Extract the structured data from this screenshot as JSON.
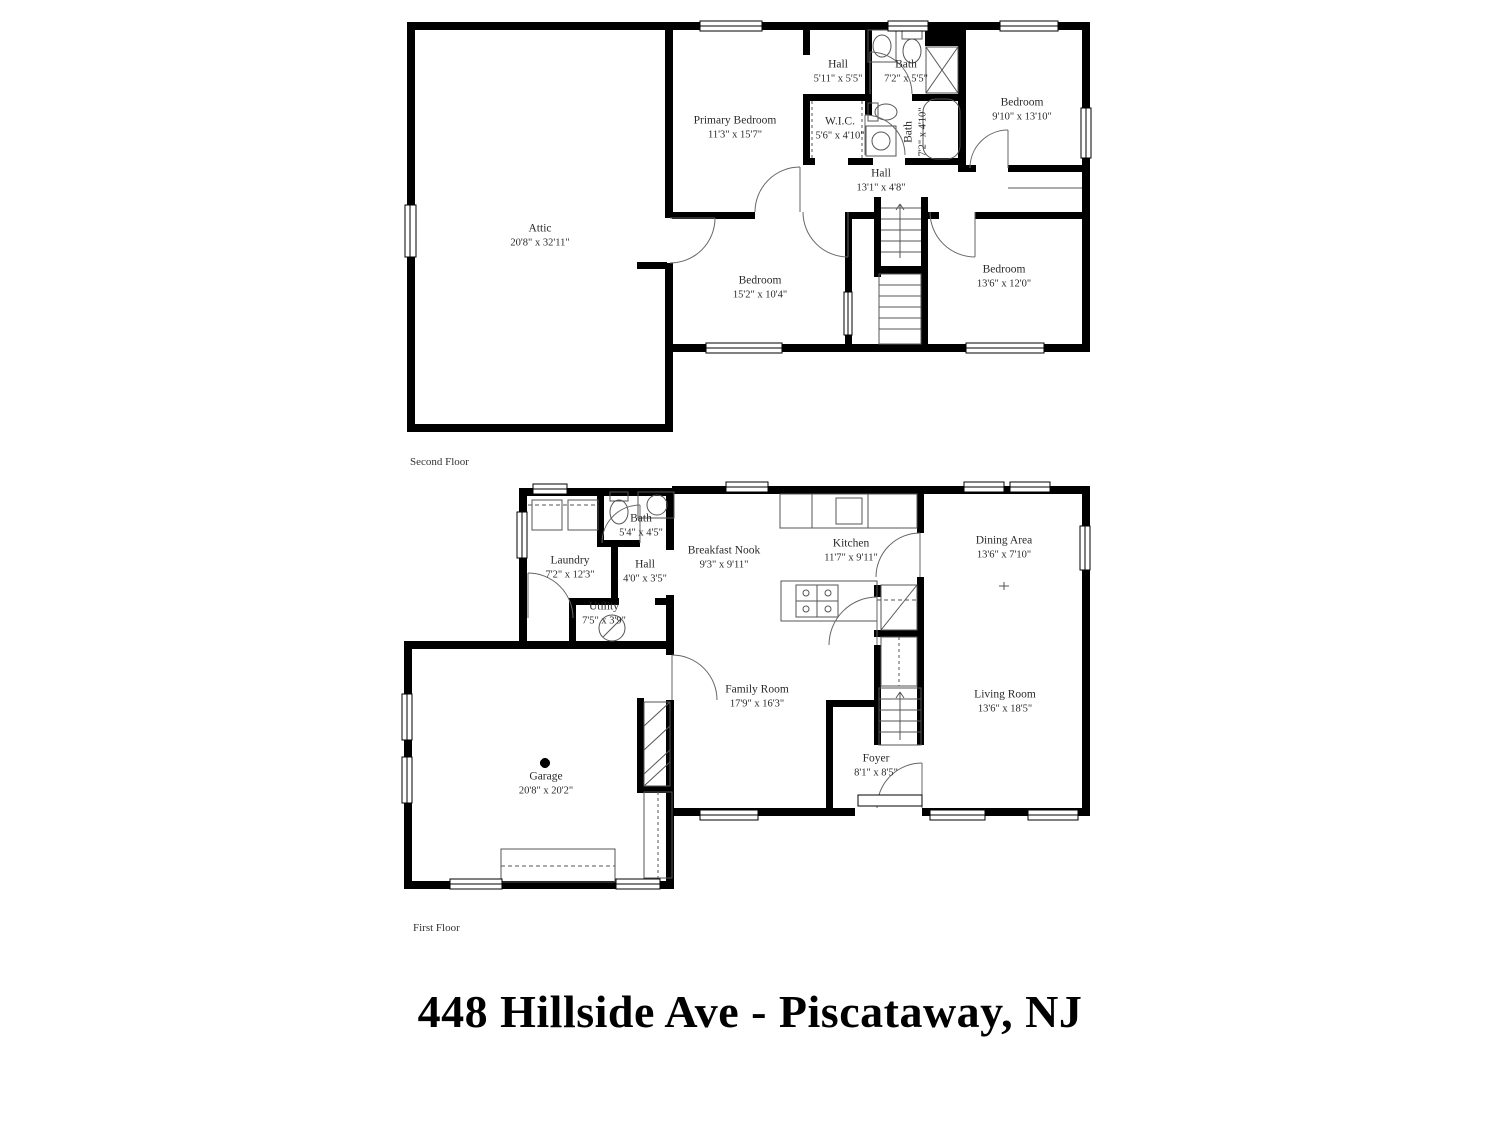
{
  "title": "448 Hillside Ave - Piscataway, NJ",
  "colors": {
    "walls": "#000000",
    "background": "#ffffff",
    "label_text": "#2a2a2a"
  },
  "floors": {
    "second": {
      "caption": "Second Floor",
      "rooms": {
        "hall_upper": {
          "name": "Hall",
          "dims": "5'11\" x 5'5\""
        },
        "bath_upper": {
          "name": "Bath",
          "dims": "7'2\" x 5'5\""
        },
        "bedroom_ne": {
          "name": "Bedroom",
          "dims": "9'10\" x 13'10\""
        },
        "primary_bedroom": {
          "name": "Primary Bedroom",
          "dims": "11'3\" x 15'7\""
        },
        "wic": {
          "name": "W.I.C.",
          "dims": "5'6\" x 4'10\""
        },
        "bath_ensuite": {
          "name": "Bath",
          "dims": "7'2\" x 4'10\""
        },
        "hall_main": {
          "name": "Hall",
          "dims": "13'1\" x 4'8\""
        },
        "attic": {
          "name": "Attic",
          "dims": "20'8\" x 32'11\""
        },
        "bedroom_sw": {
          "name": "Bedroom",
          "dims": "15'2\" x 10'4\""
        },
        "bedroom_se": {
          "name": "Bedroom",
          "dims": "13'6\" x 12'0\""
        }
      }
    },
    "first": {
      "caption": "First Floor",
      "rooms": {
        "bath": {
          "name": "Bath",
          "dims": "5'4\" x 4'5\""
        },
        "laundry": {
          "name": "Laundry",
          "dims": "7'2\" x 12'3\""
        },
        "hall": {
          "name": "Hall",
          "dims": "4'0\" x 3'5\""
        },
        "utility": {
          "name": "Utility",
          "dims": "7'5\" x 3'9\""
        },
        "breakfast_nook": {
          "name": "Breakfast Nook",
          "dims": "9'3\" x 9'11\""
        },
        "kitchen": {
          "name": "Kitchen",
          "dims": "11'7\" x 9'11\""
        },
        "dining_area": {
          "name": "Dining Area",
          "dims": "13'6\" x 7'10\""
        },
        "family_room": {
          "name": "Family Room",
          "dims": "17'9\" x 16'3\""
        },
        "living_room": {
          "name": "Living Room",
          "dims": "13'6\" x 18'5\""
        },
        "foyer": {
          "name": "Foyer",
          "dims": "8'1\" x 8'5\""
        },
        "garage": {
          "name": "Garage",
          "dims": "20'8\" x 20'2\""
        }
      }
    }
  }
}
